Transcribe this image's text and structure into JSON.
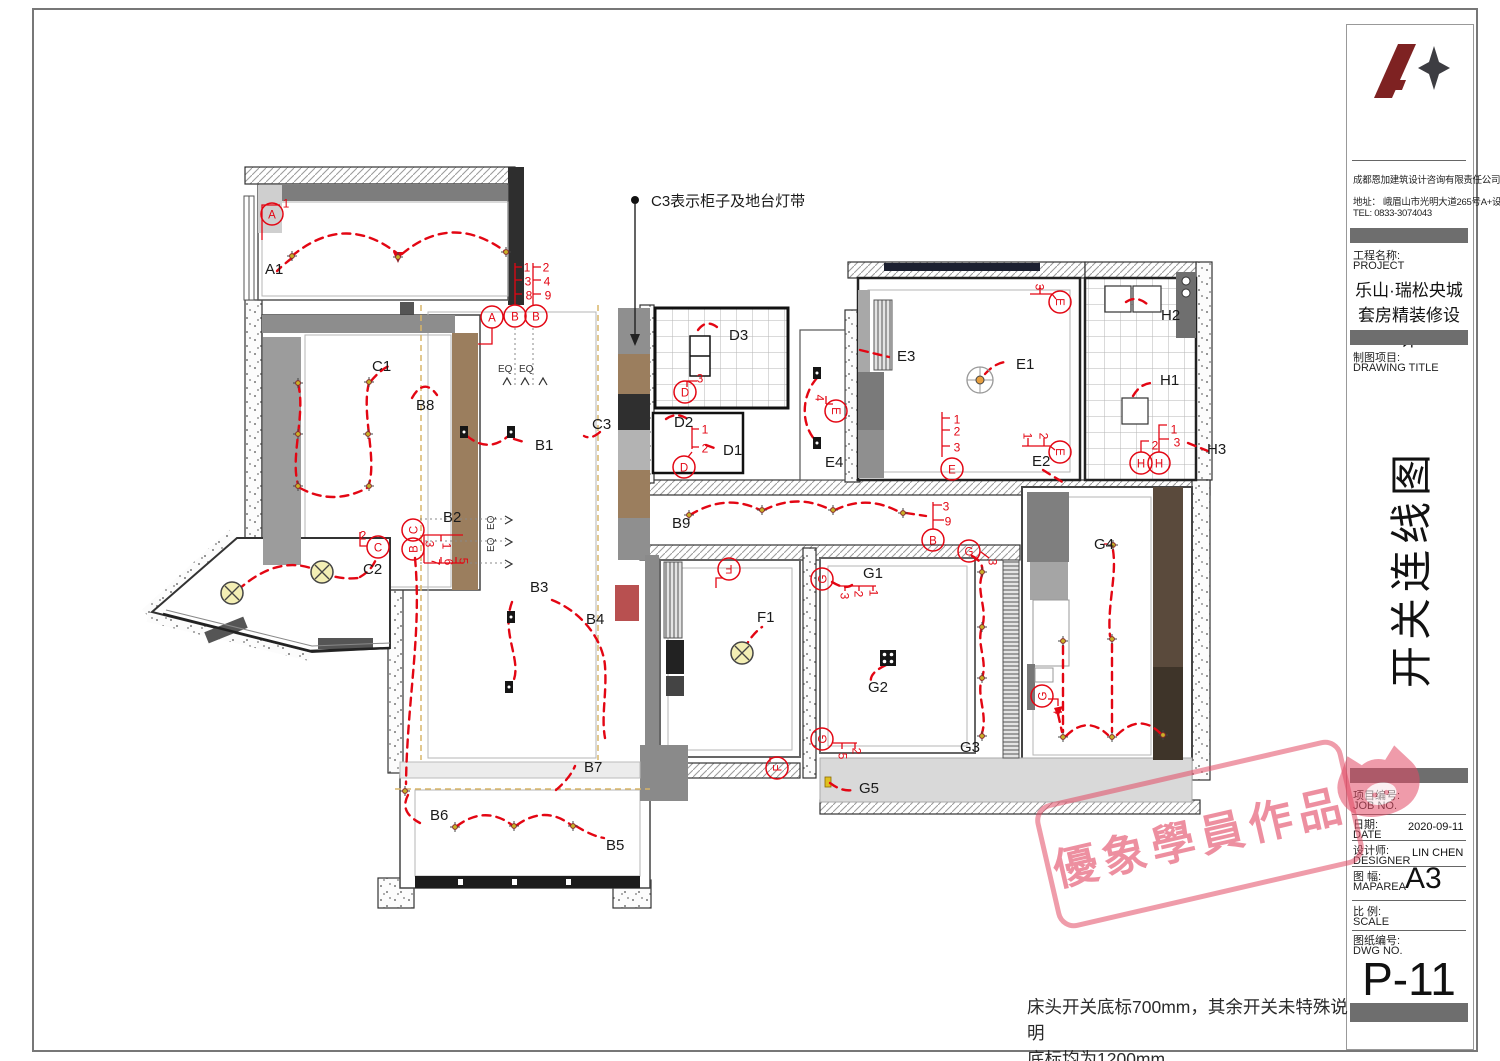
{
  "title_block": {
    "company": "成都恩加建筑设计咨询有限责任公司",
    "address": "地址： 峨眉山市光明大道265号A+设计",
    "tel": "TEL: 0833-3074043",
    "project_label_cn": "工程名称:",
    "project_label_en": "PROJECT",
    "project_name_line1": "乐山·瑞松央城",
    "project_name_line2": "套房精装修设计",
    "drawing_label_cn": "制图项目:",
    "drawing_label_en": "DRAWING TITLE",
    "drawing_title": "开关连线图",
    "fields": [
      {
        "cn": "项目编号:",
        "en": "JOB NO.",
        "value": ""
      },
      {
        "cn": "日期:",
        "en": "DATE",
        "value": "2020-09-11"
      },
      {
        "cn": "设计师:",
        "en": "DESIGNER",
        "value": "LIN CHEN"
      },
      {
        "cn": "图 幅:",
        "en": "MAPAREA",
        "value": "A3"
      },
      {
        "cn": "比 例:",
        "en": "SCALE",
        "value": ""
      },
      {
        "cn": "图纸编号:",
        "en": "DWG NO.",
        "value": ""
      }
    ],
    "dwg_no": "P-11"
  },
  "watermark": {
    "text": "優象學員作品",
    "color": "#e24a65"
  },
  "notes": {
    "line1": "床头开关底标700mm，其余开关未特殊说明",
    "line2": "底标均为1200mm"
  },
  "plan": {
    "red": "#e30613",
    "annotation": {
      "text": "C3表示柜子及地台灯带",
      "x": 651,
      "y": 206
    },
    "labels": [
      {
        "t": "A1",
        "x": 265,
        "y": 274
      },
      {
        "t": "B1",
        "x": 535,
        "y": 450
      },
      {
        "t": "B2",
        "x": 443,
        "y": 522
      },
      {
        "t": "B3",
        "x": 530,
        "y": 592
      },
      {
        "t": "B4",
        "x": 586,
        "y": 624
      },
      {
        "t": "B5",
        "x": 606,
        "y": 850
      },
      {
        "t": "B6",
        "x": 430,
        "y": 820
      },
      {
        "t": "B7",
        "x": 584,
        "y": 772
      },
      {
        "t": "B8",
        "x": 416,
        "y": 410
      },
      {
        "t": "B9",
        "x": 672,
        "y": 528
      },
      {
        "t": "C1",
        "x": 372,
        "y": 371
      },
      {
        "t": "C2",
        "x": 363,
        "y": 574
      },
      {
        "t": "C3",
        "x": 592,
        "y": 429
      },
      {
        "t": "D1",
        "x": 723,
        "y": 455
      },
      {
        "t": "D2",
        "x": 674,
        "y": 427
      },
      {
        "t": "D3",
        "x": 729,
        "y": 340
      },
      {
        "t": "E1",
        "x": 1016,
        "y": 369
      },
      {
        "t": "E2",
        "x": 1032,
        "y": 466
      },
      {
        "t": "E3",
        "x": 897,
        "y": 361
      },
      {
        "t": "E4",
        "x": 825,
        "y": 467
      },
      {
        "t": "F1",
        "x": 757,
        "y": 622
      },
      {
        "t": "G1",
        "x": 863,
        "y": 578
      },
      {
        "t": "G2",
        "x": 868,
        "y": 692
      },
      {
        "t": "G3",
        "x": 960,
        "y": 752
      },
      {
        "t": "G4",
        "x": 1094,
        "y": 549
      },
      {
        "t": "G5",
        "x": 859,
        "y": 793
      },
      {
        "t": "H1",
        "x": 1160,
        "y": 385
      },
      {
        "t": "H2",
        "x": 1161,
        "y": 320
      },
      {
        "t": "H3",
        "x": 1207,
        "y": 454
      },
      {
        "t": "EQ",
        "x": 498,
        "y": 372,
        "s": 10
      },
      {
        "t": "EQ",
        "x": 519,
        "y": 372,
        "s": 10
      },
      {
        "t": "EQ",
        "x": 494,
        "y": 530,
        "s": 10,
        "r": -90
      },
      {
        "t": "EQ",
        "x": 494,
        "y": 552,
        "s": 10,
        "r": -90
      }
    ],
    "circles": [
      {
        "l": "A",
        "x": 272,
        "y": 214
      },
      {
        "l": "A",
        "x": 492,
        "y": 317
      },
      {
        "l": "B",
        "x": 515,
        "y": 316
      },
      {
        "l": "B",
        "x": 536,
        "y": 316
      },
      {
        "l": "C",
        "x": 378,
        "y": 547
      },
      {
        "l": "C",
        "x": 413,
        "y": 530,
        "r": -90
      },
      {
        "l": "B",
        "x": 413,
        "y": 549,
        "r": -90
      },
      {
        "l": "D",
        "x": 685,
        "y": 392
      },
      {
        "l": "D",
        "x": 684,
        "y": 467
      },
      {
        "l": "E",
        "x": 952,
        "y": 469
      },
      {
        "l": "E",
        "x": 1060,
        "y": 302,
        "r": 90
      },
      {
        "l": "E",
        "x": 1060,
        "y": 452,
        "r": 90
      },
      {
        "l": "E",
        "x": 836,
        "y": 411,
        "r": 90
      },
      {
        "l": "F",
        "x": 729,
        "y": 569,
        "r": 180
      },
      {
        "l": "F",
        "x": 777,
        "y": 768,
        "r": -90
      },
      {
        "l": "G",
        "x": 822,
        "y": 579,
        "r": -90
      },
      {
        "l": "G",
        "x": 822,
        "y": 739,
        "r": -90
      },
      {
        "l": "G",
        "x": 969,
        "y": 551
      },
      {
        "l": "G",
        "x": 1042,
        "y": 696,
        "r": -90
      },
      {
        "l": "H",
        "x": 1141,
        "y": 463
      },
      {
        "l": "H",
        "x": 1159,
        "y": 463
      },
      {
        "l": "B",
        "x": 933,
        "y": 540
      }
    ],
    "numbers": [
      {
        "t": "1",
        "x": 527,
        "y": 267
      },
      {
        "t": "2",
        "x": 546,
        "y": 267
      },
      {
        "t": "3",
        "x": 528,
        "y": 281
      },
      {
        "t": "4",
        "x": 547,
        "y": 281
      },
      {
        "t": "8",
        "x": 529,
        "y": 295
      },
      {
        "t": "9",
        "x": 548,
        "y": 295
      },
      {
        "t": "1",
        "x": 286,
        "y": 203
      },
      {
        "t": "2",
        "x": 363,
        "y": 535
      },
      {
        "t": "3",
        "x": 700,
        "y": 378
      },
      {
        "t": "1",
        "x": 705,
        "y": 429
      },
      {
        "t": "2",
        "x": 705,
        "y": 448
      },
      {
        "t": "1",
        "x": 957,
        "y": 419
      },
      {
        "t": "2",
        "x": 957,
        "y": 431
      },
      {
        "t": "3",
        "x": 957,
        "y": 447
      },
      {
        "t": "3",
        "x": 1040,
        "y": 287,
        "r": 90
      },
      {
        "t": "1",
        "x": 1028,
        "y": 436,
        "r": 90
      },
      {
        "t": "2",
        "x": 1044,
        "y": 436,
        "r": 90
      },
      {
        "t": "4",
        "x": 820,
        "y": 398,
        "r": 90
      },
      {
        "t": "3",
        "x": 946,
        "y": 506
      },
      {
        "t": "9",
        "x": 948,
        "y": 521
      },
      {
        "t": "1",
        "x": 874,
        "y": 593,
        "r": 90
      },
      {
        "t": "2",
        "x": 859,
        "y": 594,
        "r": 90
      },
      {
        "t": "3",
        "x": 845,
        "y": 596,
        "r": 90
      },
      {
        "t": "2",
        "x": 857,
        "y": 751,
        "r": 90
      },
      {
        "t": "5",
        "x": 843,
        "y": 756,
        "r": 90
      },
      {
        "t": "3",
        "x": 993,
        "y": 562,
        "r": 90
      },
      {
        "t": "4",
        "x": 1058,
        "y": 711,
        "r": 90
      },
      {
        "t": "1",
        "x": 1174,
        "y": 429
      },
      {
        "t": "2",
        "x": 1155,
        "y": 445
      },
      {
        "t": "3",
        "x": 1177,
        "y": 442
      },
      {
        "t": "3",
        "x": 430,
        "y": 544,
        "r": 90
      },
      {
        "t": "1",
        "x": 447,
        "y": 546,
        "r": 90
      },
      {
        "t": "7",
        "x": 436,
        "y": 562,
        "r": 90
      },
      {
        "t": "6",
        "x": 449,
        "y": 562,
        "r": 90
      },
      {
        "t": "5",
        "x": 464,
        "y": 561,
        "r": 90
      }
    ],
    "markers": [
      [
        292,
        256
      ],
      [
        398,
        257
      ],
      [
        506,
        252
      ],
      [
        298,
        383
      ],
      [
        298,
        434
      ],
      [
        298,
        486
      ],
      [
        369,
        382
      ],
      [
        368,
        434
      ],
      [
        369,
        486
      ],
      [
        689,
        515
      ],
      [
        762,
        510
      ],
      [
        833,
        510
      ],
      [
        903,
        513
      ],
      [
        405,
        791
      ],
      [
        455,
        827
      ],
      [
        514,
        826
      ],
      [
        573,
        826
      ],
      [
        982,
        572
      ],
      [
        982,
        627
      ],
      [
        982,
        678
      ],
      [
        982,
        736
      ],
      [
        1113,
        545
      ],
      [
        1063,
        641
      ],
      [
        1112,
        639
      ],
      [
        1063,
        737
      ],
      [
        1112,
        737
      ],
      [
        1163,
        735
      ]
    ],
    "squares": [
      [
        464,
        432
      ],
      [
        511,
        432
      ],
      [
        511,
        617
      ],
      [
        509,
        687
      ],
      [
        817,
        373
      ],
      [
        817,
        443
      ]
    ],
    "lamps": [
      [
        232,
        593
      ],
      [
        322,
        572
      ],
      [
        742,
        653
      ]
    ],
    "fan": [
      980,
      380
    ],
    "dice": [
      888,
      658
    ]
  }
}
